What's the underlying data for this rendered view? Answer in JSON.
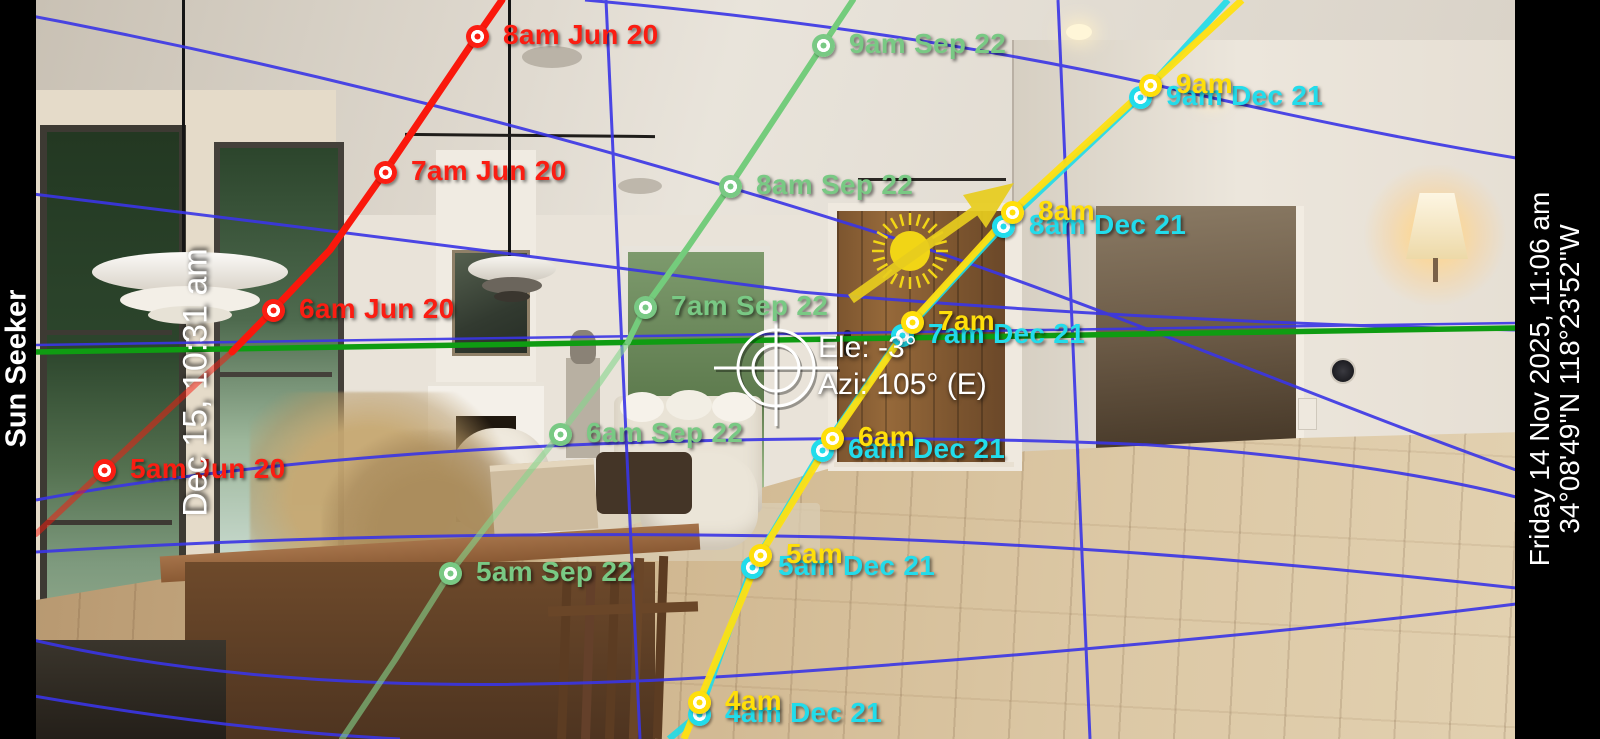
{
  "app": {
    "title": "Sun Seeker"
  },
  "overlay_panels": {
    "left_bar": {
      "app_title": "Sun Seeker",
      "selected_datetime": "Dec 15, 10:31 am"
    },
    "right_bar": {
      "current_datetime": "Friday 14 Nov 2025, 11:06 am",
      "location": "34°08'49''N 118°23'52''W"
    }
  },
  "reticle": {
    "elevation": "Ele: -3°",
    "azimuth": "Azi: 105° (E)"
  },
  "colors": {
    "june_path": "#fb1d12",
    "september_path": "#79c984",
    "today_path": "#ffdf0a",
    "december_path": "#22dceb",
    "horizon_line": "#0f9c12",
    "grid_line": "#3a35e6",
    "sun": "#f1d516"
  },
  "sun_paths": [
    {
      "id": "jun20",
      "date": "Jun 20",
      "color": "#fb1d12",
      "points": [
        {
          "label": "5am Jun 20",
          "x": 104,
          "y": 470
        },
        {
          "label": "6am Jun 20",
          "x": 273,
          "y": 310
        },
        {
          "label": "7am Jun 20",
          "x": 385,
          "y": 172
        },
        {
          "label": "8am Jun 20",
          "x": 477,
          "y": 36
        }
      ]
    },
    {
      "id": "sep22",
      "date": "Sep 22",
      "color": "#79c984",
      "points": [
        {
          "label": "5am Sep 22",
          "x": 450,
          "y": 573
        },
        {
          "label": "6am Sep 22",
          "x": 560,
          "y": 434
        },
        {
          "label": "7am Sep 22",
          "x": 645,
          "y": 307
        },
        {
          "label": "8am Sep 22",
          "x": 730,
          "y": 186
        },
        {
          "label": "9am Sep 22",
          "x": 823,
          "y": 45
        }
      ]
    },
    {
      "id": "dec21",
      "date": "Dec 21",
      "color": "#22dceb",
      "points": [
        {
          "label": "4am Dec 21",
          "x": 699,
          "y": 714
        },
        {
          "label": "5am Dec 21",
          "x": 752,
          "y": 567
        },
        {
          "label": "6am Dec 21",
          "x": 822,
          "y": 450
        },
        {
          "label": "7am Dec 21",
          "x": 902,
          "y": 335
        },
        {
          "label": "8am Dec 21",
          "x": 1003,
          "y": 226
        },
        {
          "label": "9am Dec 21",
          "x": 1140,
          "y": 97
        }
      ]
    },
    {
      "id": "today",
      "date": "",
      "color": "#ffdf0a",
      "points": [
        {
          "label": "4am",
          "x": 699,
          "y": 702
        },
        {
          "label": "5am",
          "x": 760,
          "y": 555
        },
        {
          "label": "6am",
          "x": 832,
          "y": 438
        },
        {
          "label": "7am",
          "x": 912,
          "y": 322
        },
        {
          "label": "8am",
          "x": 1012,
          "y": 212
        },
        {
          "label": "9am",
          "x": 1150,
          "y": 85
        }
      ]
    }
  ]
}
